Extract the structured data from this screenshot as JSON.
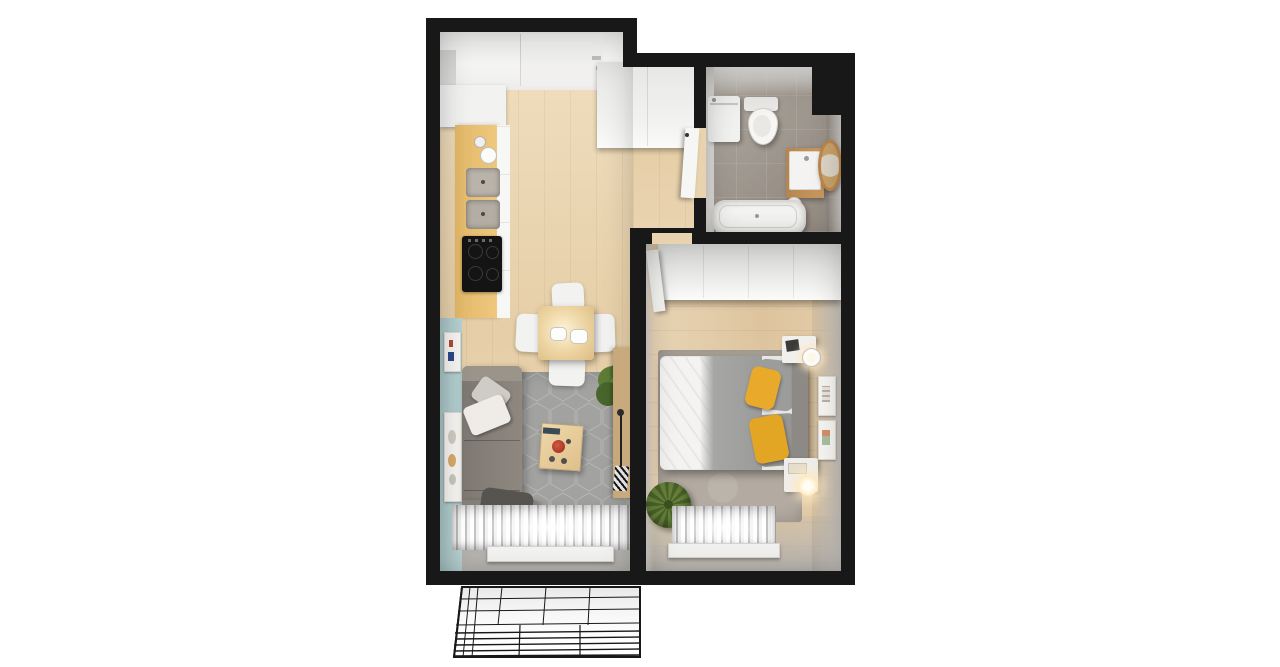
{
  "meta": {
    "title": "One-bedroom apartment — top-down 3D floor-plan render",
    "view": "top-down axonometric",
    "style": "photorealistic render on white background, black wall outlines, unrendered wireframe balcony"
  },
  "palette": {
    "bg": "#ffffff",
    "wall": "#181818",
    "wood": "#e9d3ae",
    "woodBedroom": "#e2cbab",
    "counterWood": "#eec87e",
    "teal": "#b7d1d2",
    "tile": "#a59e96",
    "rugLiving": "#a2a2a0",
    "rugBedroom": "#b3aba1",
    "sofa": "#8e8881",
    "sofaDark": "#57534f",
    "whiteFurniture": "#f2f2f1",
    "cooktop": "#141414",
    "tableWood": "#ecd3a0",
    "redBowl": "#b13c2b",
    "plantGreen": "#5d7d36",
    "poufGreen": "#66813c",
    "bedGray": "#a6a6a4",
    "headboard": "#8d8984",
    "yellow": "#e9a92b",
    "gold": "#bd8749",
    "curtainShadow": "#c2c2c2",
    "frame": "#f6f5f2",
    "grayFloor": "#b6b3af",
    "lampGlow": "#ffe9c4"
  },
  "rooms": {
    "living": {
      "label": "Open-plan kitchen and living room",
      "furniture": [
        "kitchen counter with sink and induction cooktop",
        "tall white cabinet",
        "square dining table with four white chairs and two plates",
        "L-shaped gray sofa with pillows",
        "wooden coffee table with red bowl",
        "gray hexagon-pattern rug",
        "potted green plant",
        "narrow console with floor lamp",
        "teal accent wall with two framed artworks",
        "window with white pleated curtains"
      ]
    },
    "hallway": {
      "label": "Entrance hallway",
      "furniture": [
        "entrance door",
        "built-in closet",
        "open bathroom door"
      ]
    },
    "bathroom": {
      "label": "Bathroom",
      "furniture": [
        "washing machine",
        "wall-hung toilet",
        "vanity washbasin on wooden stand",
        "round gold-framed mirror",
        "bathtub"
      ]
    },
    "bedroom": {
      "label": "Bedroom",
      "furniture": [
        "white wardrobe along top wall",
        "double bed with white duvet, gray blanket and yellow pillows",
        "upholstered headboard",
        "two nightstands with lamps",
        "two framed pictures on wall",
        "green knitted pouf",
        "gray rug",
        "window with white pleated curtains"
      ]
    },
    "balcony": {
      "label": "Balcony drawn as black wireframe",
      "furniture": [
        "railing with horizontal bars",
        "gridded floor"
      ]
    }
  }
}
